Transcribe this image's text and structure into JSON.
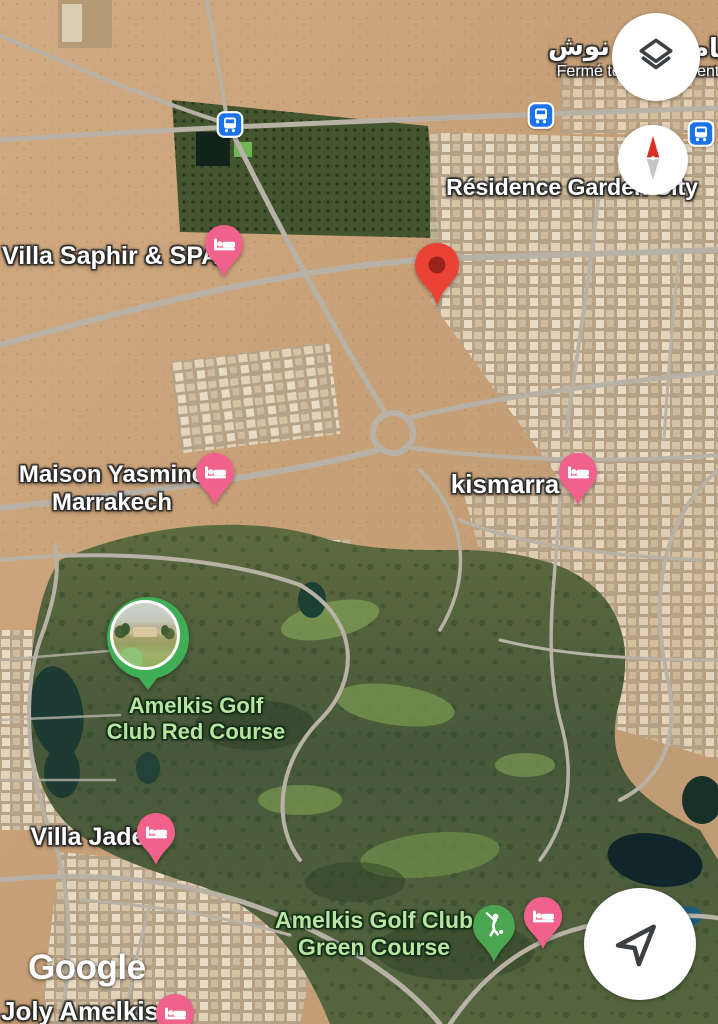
{
  "branding": {
    "google": "Google"
  },
  "top_right_poi": {
    "name_ar_start": "تام",
    "name_ar_end": "نوش",
    "status": "Fermé temporairement"
  },
  "labels": {
    "residence_garden_city": "Résidence Garden City",
    "villa_saphir_spa": "Villa Saphir & SPA",
    "maison_yasmine": {
      "line1": "Maison Yasmine",
      "line2": "Marrakech"
    },
    "kismarra": "kismarra",
    "amelkis_red": {
      "line1": "Amelkis Golf",
      "line2": "Club Red Course"
    },
    "villa_jade": "Villa Jade",
    "amelkis_green": {
      "line1": "Amelkis Golf Club",
      "line2": "Green Course"
    },
    "joly_amelkis": "Joly Amelkis"
  },
  "markers": {
    "destination": "red-map-marker",
    "hotel_pin_count": 6,
    "golf_pin": "golfer-pin",
    "photo_pin_for": "Amelkis Golf Club Red Course",
    "bus_stop_count": 3
  },
  "controls": {
    "layers_button": "layers-icon",
    "compass_button": "compass-needle-icon",
    "my_location_button": "navigation-arrow-icon"
  },
  "colors": {
    "transit_blue": "#1A73E8",
    "hotel_pin_pink": "#F0618C",
    "destination_red": "#EA4335",
    "destination_red_inner": "#99231B",
    "golf_pin_green": "#4CA550",
    "photo_ring_green": "#3FAE54",
    "nature_label_green": "#B9E5A2",
    "label_white": "#FFFFFF",
    "road_gray": "#B8B2A6"
  }
}
